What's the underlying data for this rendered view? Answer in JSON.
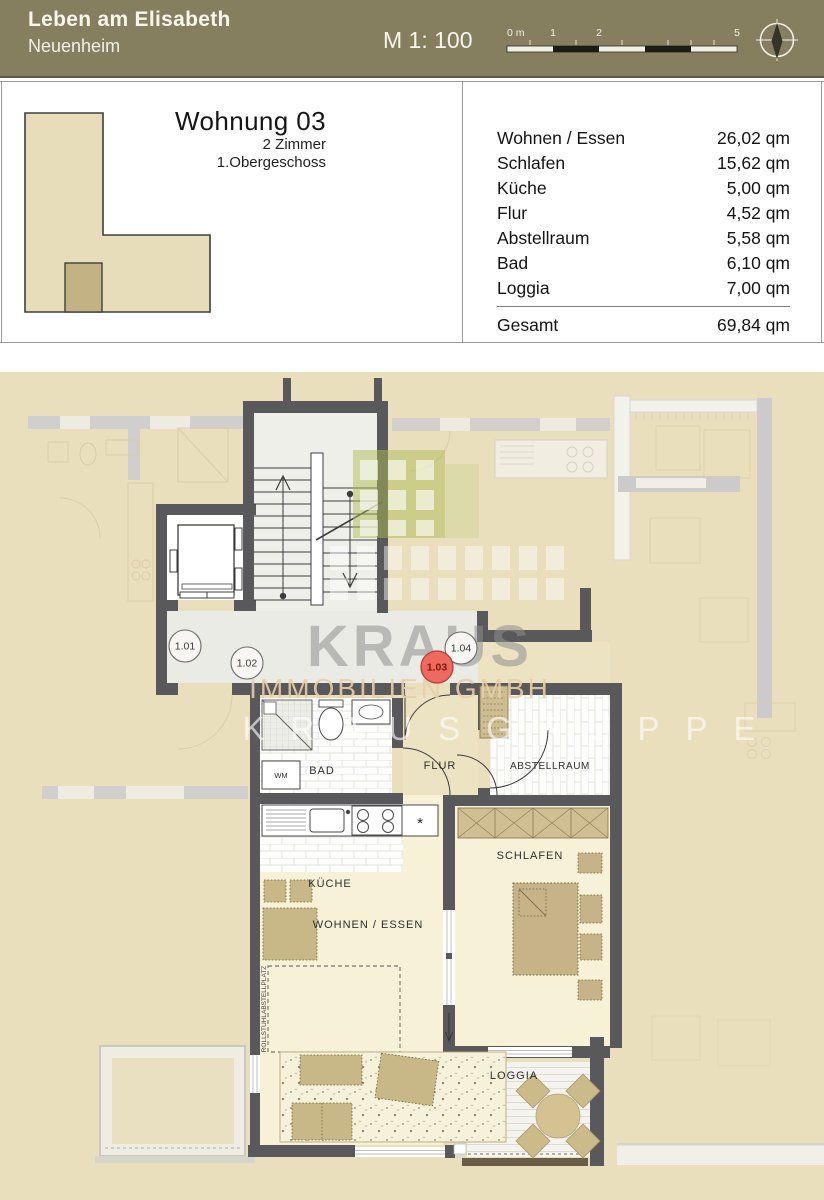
{
  "header": {
    "project_title": "Leben am Elisabeth",
    "project_subtitle": "Neuenheim",
    "scale_label": "M 1: 100",
    "scalebar_labels": {
      "zero": "0 m",
      "one": "1",
      "two": "2",
      "five": "5"
    }
  },
  "unit_info": {
    "title": "Wohnung 03",
    "line1": "2 Zimmer",
    "line2": "1.Obergeschoss"
  },
  "area_table": {
    "rows": [
      {
        "label": "Wohnen / Essen",
        "value": "26,02 qm"
      },
      {
        "label": "Schlafen",
        "value": "15,62 qm"
      },
      {
        "label": "Küche",
        "value": "5,00 qm"
      },
      {
        "label": "Flur",
        "value": "4,52 qm"
      },
      {
        "label": "Abstellraum",
        "value": "5,58 qm"
      },
      {
        "label": "Bad",
        "value": "6,10 qm"
      },
      {
        "label": "Loggia",
        "value": "7,00 qm"
      }
    ],
    "total": {
      "label": "Gesamt",
      "value": "69,84 qm"
    }
  },
  "floorplan": {
    "rooms": {
      "bad": "BAD",
      "flur": "FLUR",
      "abstellraum": "ABSTELLRAUM",
      "kueche": "KÜCHE",
      "schlafen": "SCHLAFEN",
      "wohnen_essen": "WOHNEN / ESSEN",
      "loggia": "LOGGIA"
    },
    "labels": {
      "wm": "WM",
      "dishwasher_star": "*",
      "rollstuhl": "ROLLSTUHLABSTELLPLATZ"
    },
    "unit_markers": [
      {
        "label": "1.01",
        "highlighted": false
      },
      {
        "label": "1.02",
        "highlighted": false
      },
      {
        "label": "1.03",
        "highlighted": true
      },
      {
        "label": "1.04",
        "highlighted": false
      }
    ],
    "watermark": {
      "brand": "KRAUS",
      "line2": "IMMOBILIEN GMBH",
      "line3": "KRAUSGRUPPE"
    },
    "colors": {
      "background": "#e9dfbd",
      "wall": "#59585a",
      "accent_red": "#ee6a5e",
      "logo_green": "#aebc53",
      "furniture_tan": "#c8b787"
    }
  }
}
